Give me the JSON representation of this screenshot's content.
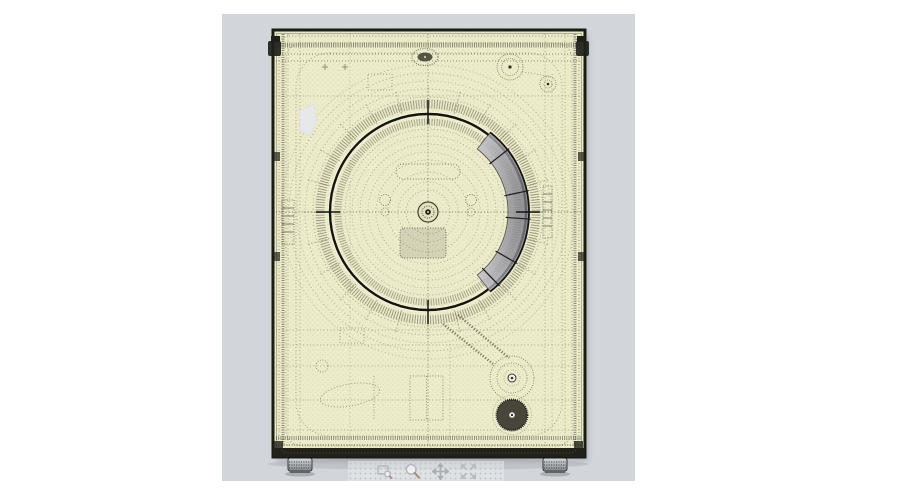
{
  "window": {
    "background": "#ffffff"
  },
  "viewport": {
    "background": "#d2d6da",
    "description": "3D CAD wireframe rear view of a front-load washing machine"
  },
  "model": {
    "name": "washing-machine-rear-wireframe",
    "body_color": "#edecca",
    "edge_color": "#1b1b12",
    "wire_color": "#6a6954",
    "dense_wire_color": "#3f3e30",
    "seal_accent_color": "#8e8d9c",
    "foot_color": "#9a9ea2"
  },
  "toolbar": {
    "background": "rgba(233,236,238,0.55)",
    "icon_color": "#b3b8be",
    "zoom_handle_color": "#b28f77",
    "buttons": [
      {
        "name": "zoom-window",
        "label": "Zoom window"
      },
      {
        "name": "zoom",
        "label": "Zoom"
      },
      {
        "name": "pan",
        "label": "Pan"
      },
      {
        "name": "fit-view",
        "label": "Fit to view"
      }
    ]
  }
}
